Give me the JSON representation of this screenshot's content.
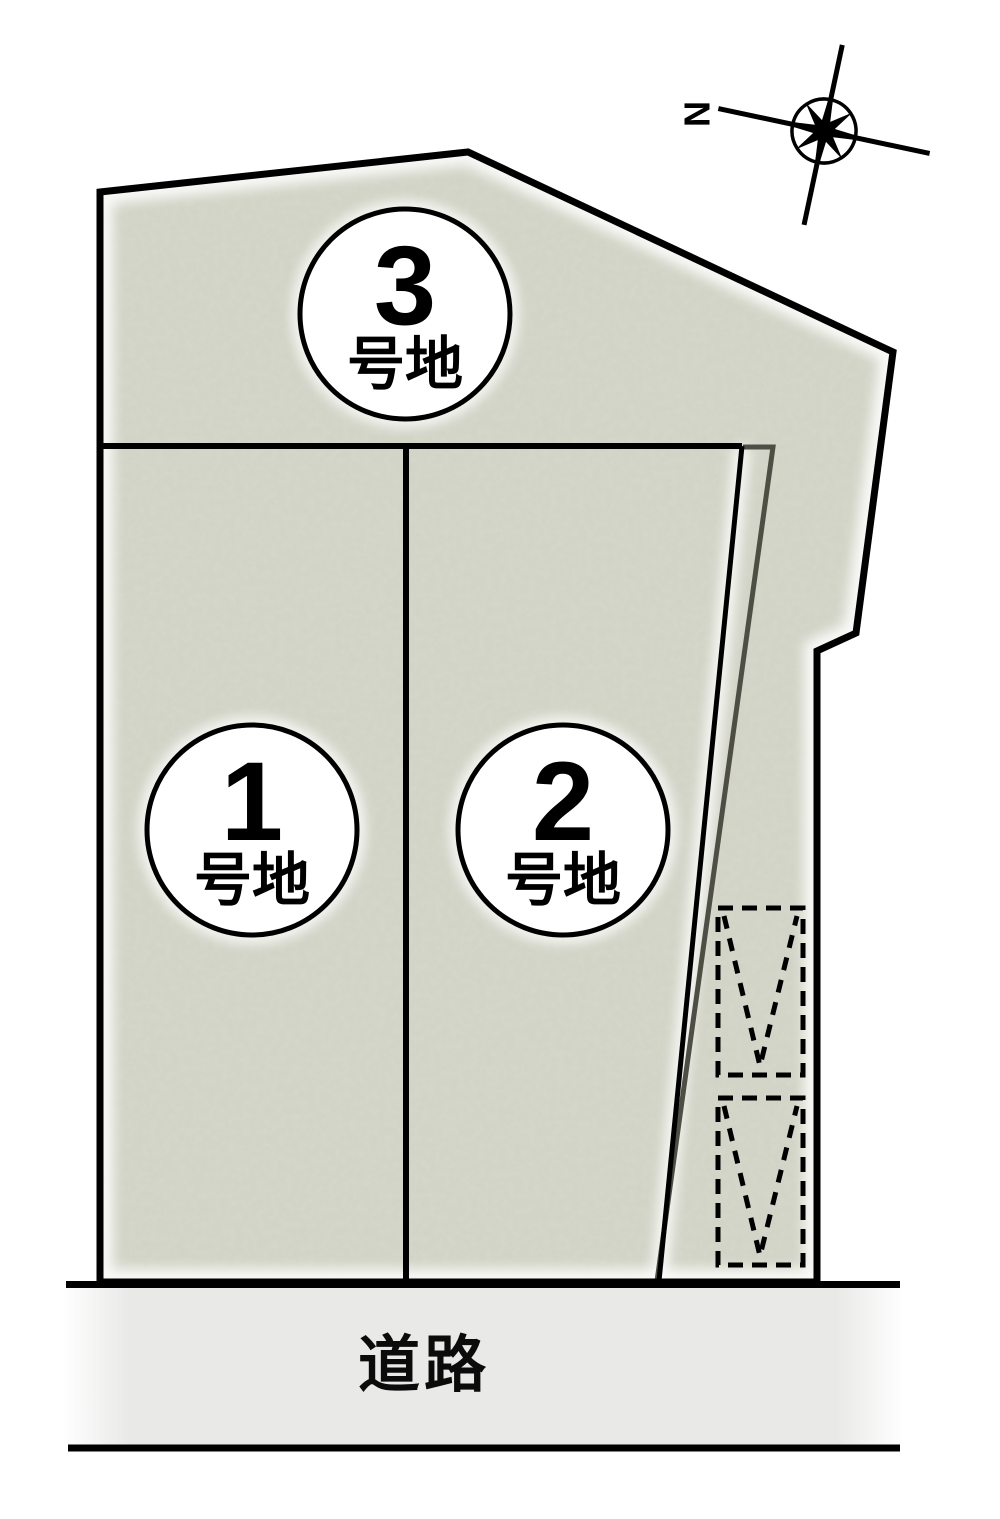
{
  "compass": {
    "north_label": "N"
  },
  "road": {
    "label": "道路"
  },
  "lots": [
    {
      "number": "1",
      "suffix": "号地"
    },
    {
      "number": "2",
      "suffix": "号地"
    },
    {
      "number": "3",
      "suffix": "号地"
    }
  ],
  "colors": {
    "lot_fill": "#d5d7ca",
    "road_fill": "#e9e9e8",
    "outline": "#000000",
    "offset_line": "#4e4e45",
    "badge_fill": "#ffffff"
  }
}
